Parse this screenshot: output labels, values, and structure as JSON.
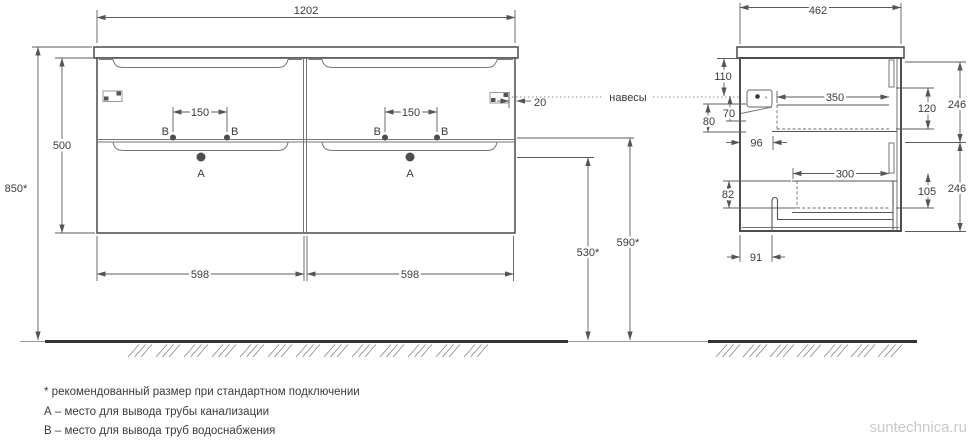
{
  "dims": {
    "front": {
      "width": "1202",
      "height": "500",
      "total_height": "850*",
      "hole_spacing": "150",
      "drawer_width": "598",
      "hanger_offset": "20",
      "supply_height": "590*",
      "drain_height": "530*"
    },
    "side": {
      "depth": "462",
      "d110": "110",
      "d70": "70",
      "d80": "80",
      "d96": "96",
      "d350": "350",
      "d120": "120",
      "d246": "246",
      "d82": "82",
      "d300": "300",
      "d105": "105",
      "d91": "91"
    }
  },
  "labels": {
    "hangers": "навесы",
    "point_a": "A",
    "point_b": "B"
  },
  "footnotes": [
    "* рекомендованный размер при стандартном подключении",
    "А – место для вывода трубы канализации",
    "В – место для вывода труб водоснабжения"
  ],
  "watermark": "suntechnica.ru",
  "colors": {
    "line": "#4a4a4a",
    "dimension": "#5c5c5c",
    "text": "#3a3a3a",
    "ground": "#333333",
    "watermark": "#c9c9c9"
  }
}
